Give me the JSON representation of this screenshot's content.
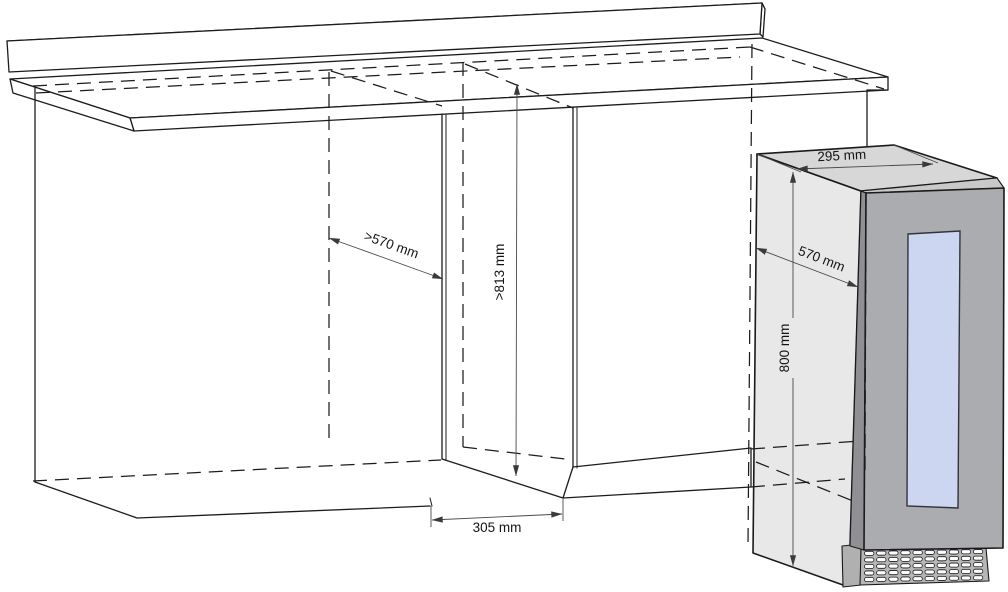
{
  "diagram_name": "built-in wine cooler niche installation diagram",
  "dimensions": {
    "niche_depth": ">570 mm",
    "niche_height": ">813 mm",
    "niche_width": "305 mm",
    "appliance_width": "295 mm",
    "appliance_depth": "570 mm",
    "appliance_height": "800 mm"
  },
  "colors": {
    "outline": "#1c1c1c",
    "dimension_line": "#4a4a4a",
    "side_panel": "#e8e8e8",
    "top_face": "#d7d7d7",
    "door_face": "#abacaf",
    "door_top_bevel": "#c9c9c9",
    "frame_strip": "#909094",
    "plinth_side": "#b0b0b0",
    "grille_face": "#b6b6b6",
    "grille_slot": "#ffffff",
    "glass": "#cdd6f0"
  },
  "grille": {
    "rows": 5,
    "columns": 10
  }
}
